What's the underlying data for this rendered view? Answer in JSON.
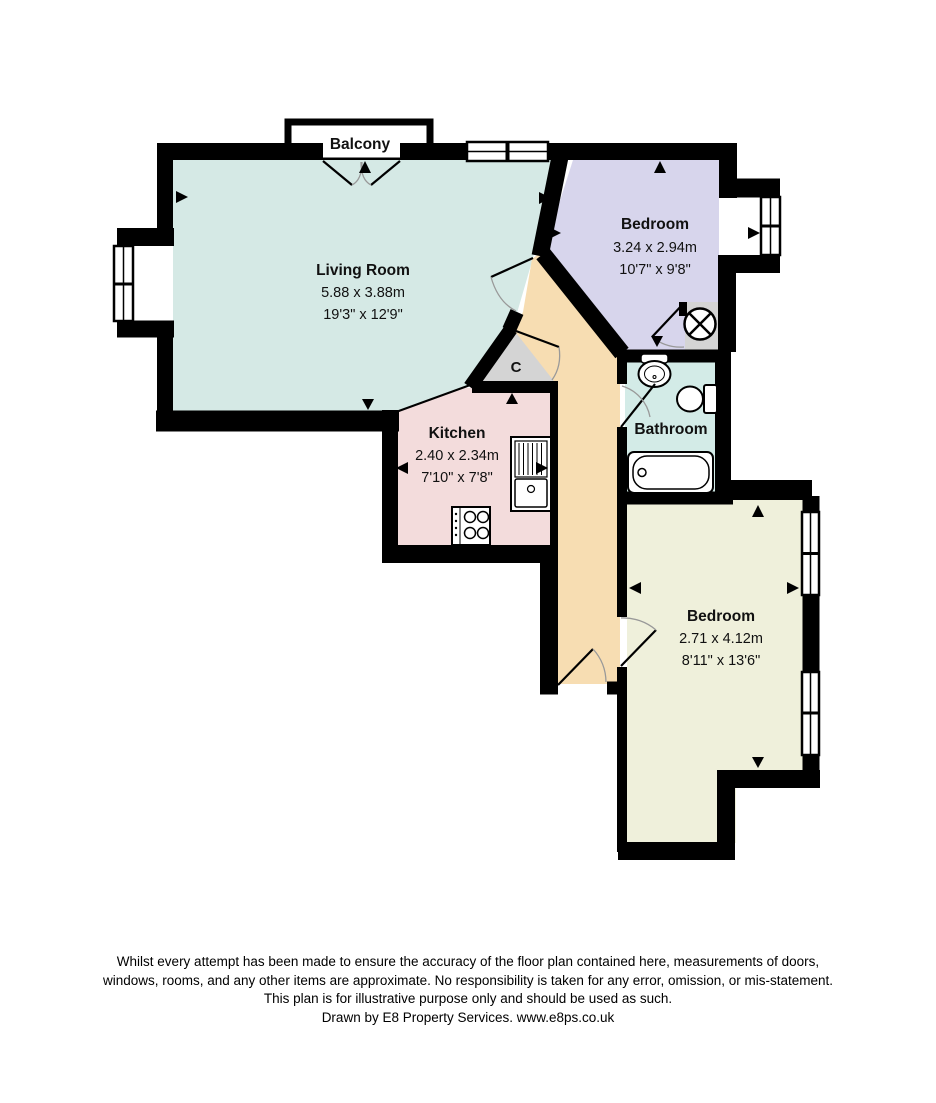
{
  "floorplan": {
    "balcony_label": "Balcony",
    "closet_label": "C",
    "rooms": {
      "living_room": {
        "name": "Living Room",
        "metric": "5.88 x 3.88m",
        "imperial": "19'3\" x 12'9\""
      },
      "bedroom_top": {
        "name": "Bedroom",
        "metric": "3.24 x 2.94m",
        "imperial": "10'7\" x 9'8\""
      },
      "kitchen": {
        "name": "Kitchen",
        "metric": "2.40 x 2.34m",
        "imperial": "7'10\" x 7'8\""
      },
      "bathroom": {
        "name": "Bathroom"
      },
      "bedroom_bottom": {
        "name": "Bedroom",
        "metric": "2.71 x 4.12m",
        "imperial": "8'11\" x 13'6\""
      }
    },
    "colors": {
      "living_room": "#d5e9e5",
      "bedroom_top": "#d7d5ec",
      "bedroom_bottom": "#eff0db",
      "kitchen": "#f3dcdc",
      "bathroom": "#d3ebe7",
      "hallway": "#f7ddb2",
      "closet": "#d4d4d4",
      "wall": "#000000"
    }
  },
  "disclaimer": {
    "line1": "Whilst every attempt has been made to ensure the accuracy of the floor plan contained here, measurements of doors,",
    "line2": "windows, rooms, and any other items are approximate. No responsibility is taken for any error, omission, or mis-statement.",
    "line3": "This plan is for illustrative purpose only and should be used as such.",
    "credit": "Drawn by E8 Property Services. www.e8ps.co.uk"
  }
}
